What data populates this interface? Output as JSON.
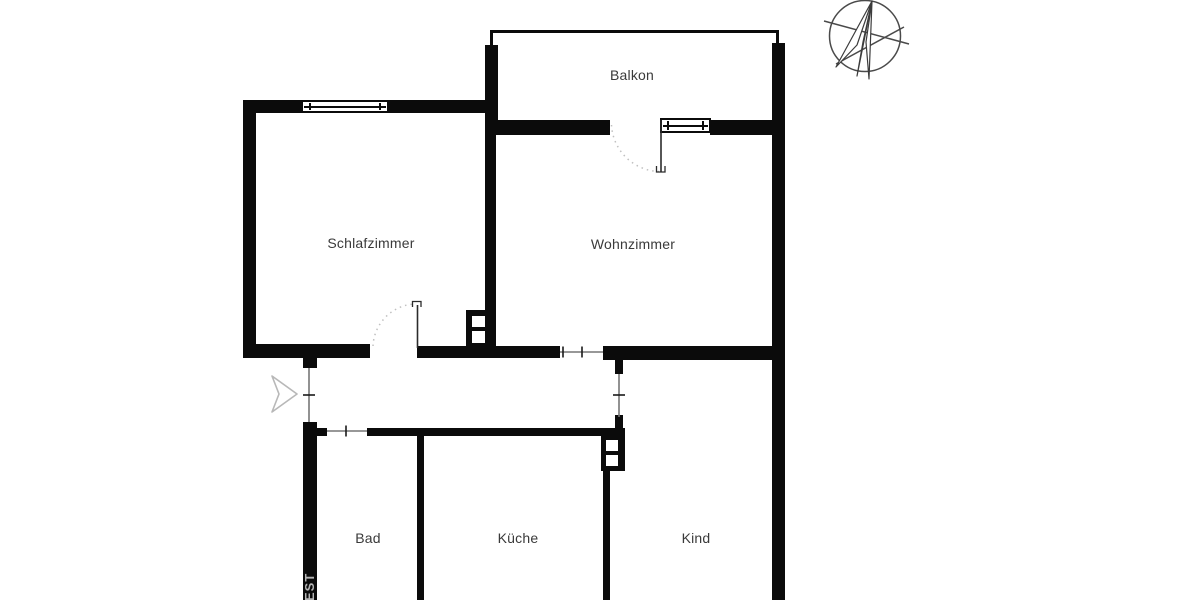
{
  "plan": {
    "kind": "apartment-floor-plan",
    "language": "de"
  },
  "rooms": [
    {
      "id": "balkon",
      "label": "Balkon"
    },
    {
      "id": "schlafzimmer",
      "label": "Schlafzimmer"
    },
    {
      "id": "wohnzimmer",
      "label": "Wohnzimmer"
    },
    {
      "id": "bad",
      "label": "Bad"
    },
    {
      "id": "kueche",
      "label": "Küche"
    },
    {
      "id": "kind",
      "label": "Kind"
    }
  ],
  "watermark": {
    "text": "EST"
  },
  "icons": [
    {
      "name": "compass-rose-icon",
      "meaning": "north orientation compass, top right"
    },
    {
      "name": "entrance-arrow-icon",
      "meaning": "apartment entrance direction arrow, left side"
    }
  ],
  "symbols": {
    "windows": 2,
    "door_swings": 2,
    "wall_openings": 4,
    "ventilation_shafts": 2
  },
  "colors": {
    "wall": "#0b0b0b",
    "background": "#ffffff",
    "label_text": "#3a3a3a",
    "door_arc": "#c0c0c0",
    "opening_line": "#777777",
    "entrance_arrow_stroke": "#b8b8b8",
    "compass_stroke": "#4a4a4a",
    "watermark_text": "#b5b5b5"
  }
}
